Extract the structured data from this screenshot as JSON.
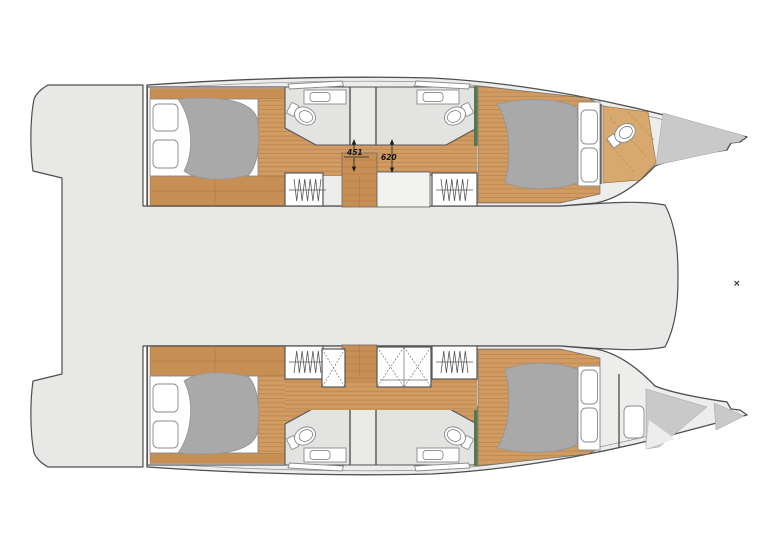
{
  "annotations": {
    "dimensions": {
      "aft_passage": "451",
      "forward_passage": "620"
    },
    "corner_marker": "×"
  },
  "colors": {
    "deck": "#e8e8e6",
    "hull": "#ededec",
    "wood": "#d19b62",
    "woodd": "#c88f55",
    "stripe": "#a87a45",
    "bed": "#a9a9a9",
    "bow": "#c9c9c9",
    "outline": "#4f4f4f",
    "green": "#55784f"
  }
}
